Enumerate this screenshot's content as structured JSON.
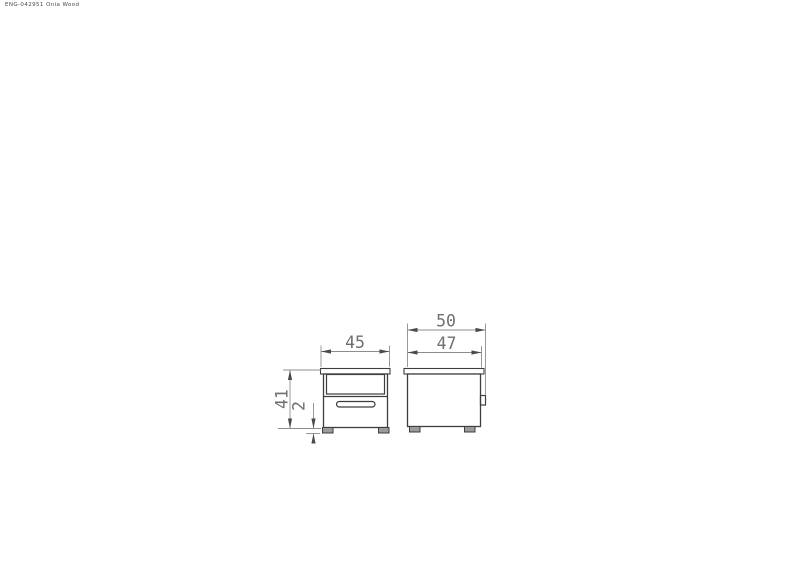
{
  "header": {
    "doc_ref": "ENG-042951 Onia Wood"
  },
  "drawing": {
    "front_view": {
      "width_cm": "45",
      "height_cm": "41",
      "foot_height_cm": "2"
    },
    "side_view": {
      "overall_depth_cm": "50",
      "carcass_depth_cm": "47"
    }
  },
  "colors": {
    "bg": "#ffffff",
    "outline": "#3e3e3e",
    "dim_line": "#8d8d8d",
    "dim_text": "#6f6f6f",
    "arrow": "#4a4a4a",
    "foot_fill": "#9b9b9b",
    "doc_text": "#4a4a4a"
  }
}
